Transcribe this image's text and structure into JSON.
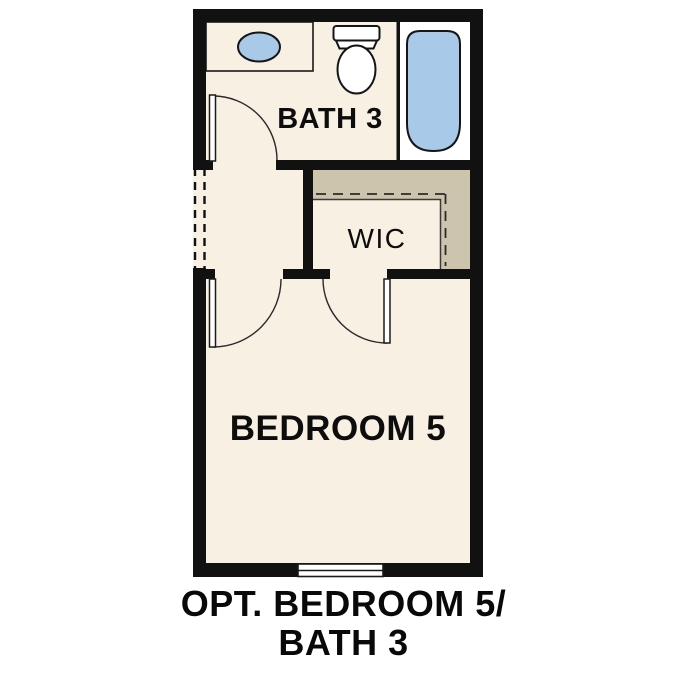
{
  "plan": {
    "rooms": {
      "bath": {
        "label": "BATH 3"
      },
      "wic": {
        "label": "WIC"
      },
      "bedroom": {
        "label": "BEDROOM 5"
      }
    },
    "fixtures": [
      "vanity-counter",
      "sink",
      "toilet",
      "bathtub",
      "bath-door-swing",
      "bedroom-door-swing",
      "wic-door-swing",
      "closet-shelf",
      "window",
      "cased-opening-dashed"
    ],
    "colors": {
      "wall": "#111111",
      "floor": "#f7f0e3",
      "counter_tan": "#cdc4ae",
      "closet_tan": "#cdc4ae",
      "fixture_blue": "#a9c9e9",
      "tub_room_floor": "#ffffff",
      "fixture_white": "#ffffff"
    }
  },
  "caption": {
    "line1": "OPT. BEDROOM 5/",
    "line2": "BATH 3"
  }
}
